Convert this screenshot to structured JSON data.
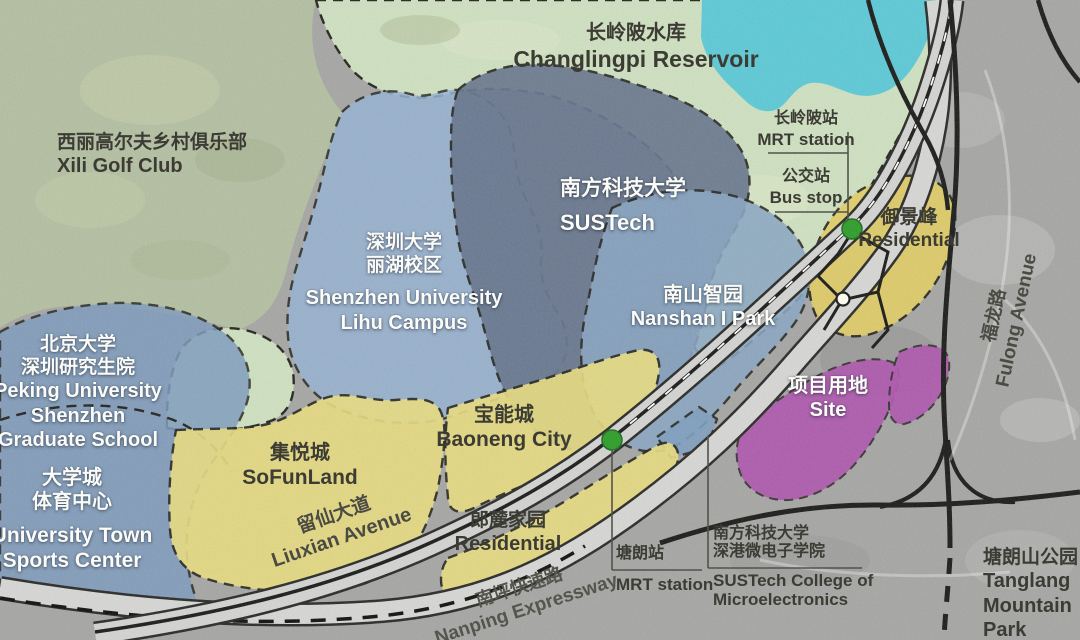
{
  "map": {
    "regions": {
      "xili_golf": {
        "zh": "西丽高尔夫乡村俱乐部",
        "en": "Xili Golf Club"
      },
      "changlingpi_reservoir": {
        "zh": "长岭陂水库",
        "en": "Changlingpi Reservoir"
      },
      "sustech": {
        "zh": "南方科技大学",
        "en": "SUSTech"
      },
      "szu_lihu": {
        "zh1": "深圳大学",
        "zh2": "丽湖校区",
        "en1": "Shenzhen University",
        "en2": "Lihu Campus"
      },
      "pku": {
        "zh1": "北京大学",
        "zh2": "深圳研究生院",
        "en1": "Peking University",
        "en2": "Shenzhen",
        "en3": "Graduate School"
      },
      "sports_center": {
        "zh1": "大学城",
        "zh2": "体育中心",
        "en1": "University Town",
        "en2": "Sports Center"
      },
      "sofunland": {
        "zh": "集悦城",
        "en": "SoFunLand"
      },
      "baoneng_city": {
        "zh": "宝能城",
        "en": "Baoneng City"
      },
      "nanshan_i_park": {
        "zh": "南山智园",
        "en": "Nanshan I Park"
      },
      "langlu": {
        "zh": "郎麓家园",
        "en": "Residential"
      },
      "yujingfeng": {
        "zh": "御景峰",
        "en": "Residential"
      },
      "site": {
        "zh": "项目用地",
        "en": "Site"
      },
      "microelectronics": {
        "zh1": "南方科技大学",
        "zh2": "深港微电子学院",
        "en1": "SUSTech College of",
        "en2": "Microelectronics"
      },
      "tanglang_park": {
        "zh": "塘朗山公园",
        "en1": "Tanglang",
        "en2": "Mountain",
        "en3": "Park"
      }
    },
    "roads": {
      "liuxian": {
        "zh": "留仙大道",
        "en": "Liuxian Avenue"
      },
      "nanping": {
        "zh": "南坪快速路",
        "en": "Nanping Expressway"
      },
      "fulong": {
        "zh": "福龙路",
        "en": "Fulong Avenue"
      }
    },
    "transit": {
      "changlingpi_station": {
        "zh": "长岭陂站",
        "en": "MRT station"
      },
      "bus_stop": {
        "zh": "公交站",
        "en": "Bus stop"
      },
      "tanglang_station": {
        "zh": "塘朗站",
        "en": "MRT station"
      }
    },
    "colors": {
      "park_green": "#b3bfa2",
      "reserve_green": "#cfe0c0",
      "water_teal": "#5ec9d6",
      "campus_blue": "#8aa6c3",
      "residential_yellow": "#e9dd80",
      "site_purple": "#af58ae",
      "station_green": "#2f9e2a",
      "road_gray": "#d3d3d1",
      "satellite_gray": "#a6a6a4"
    }
  }
}
